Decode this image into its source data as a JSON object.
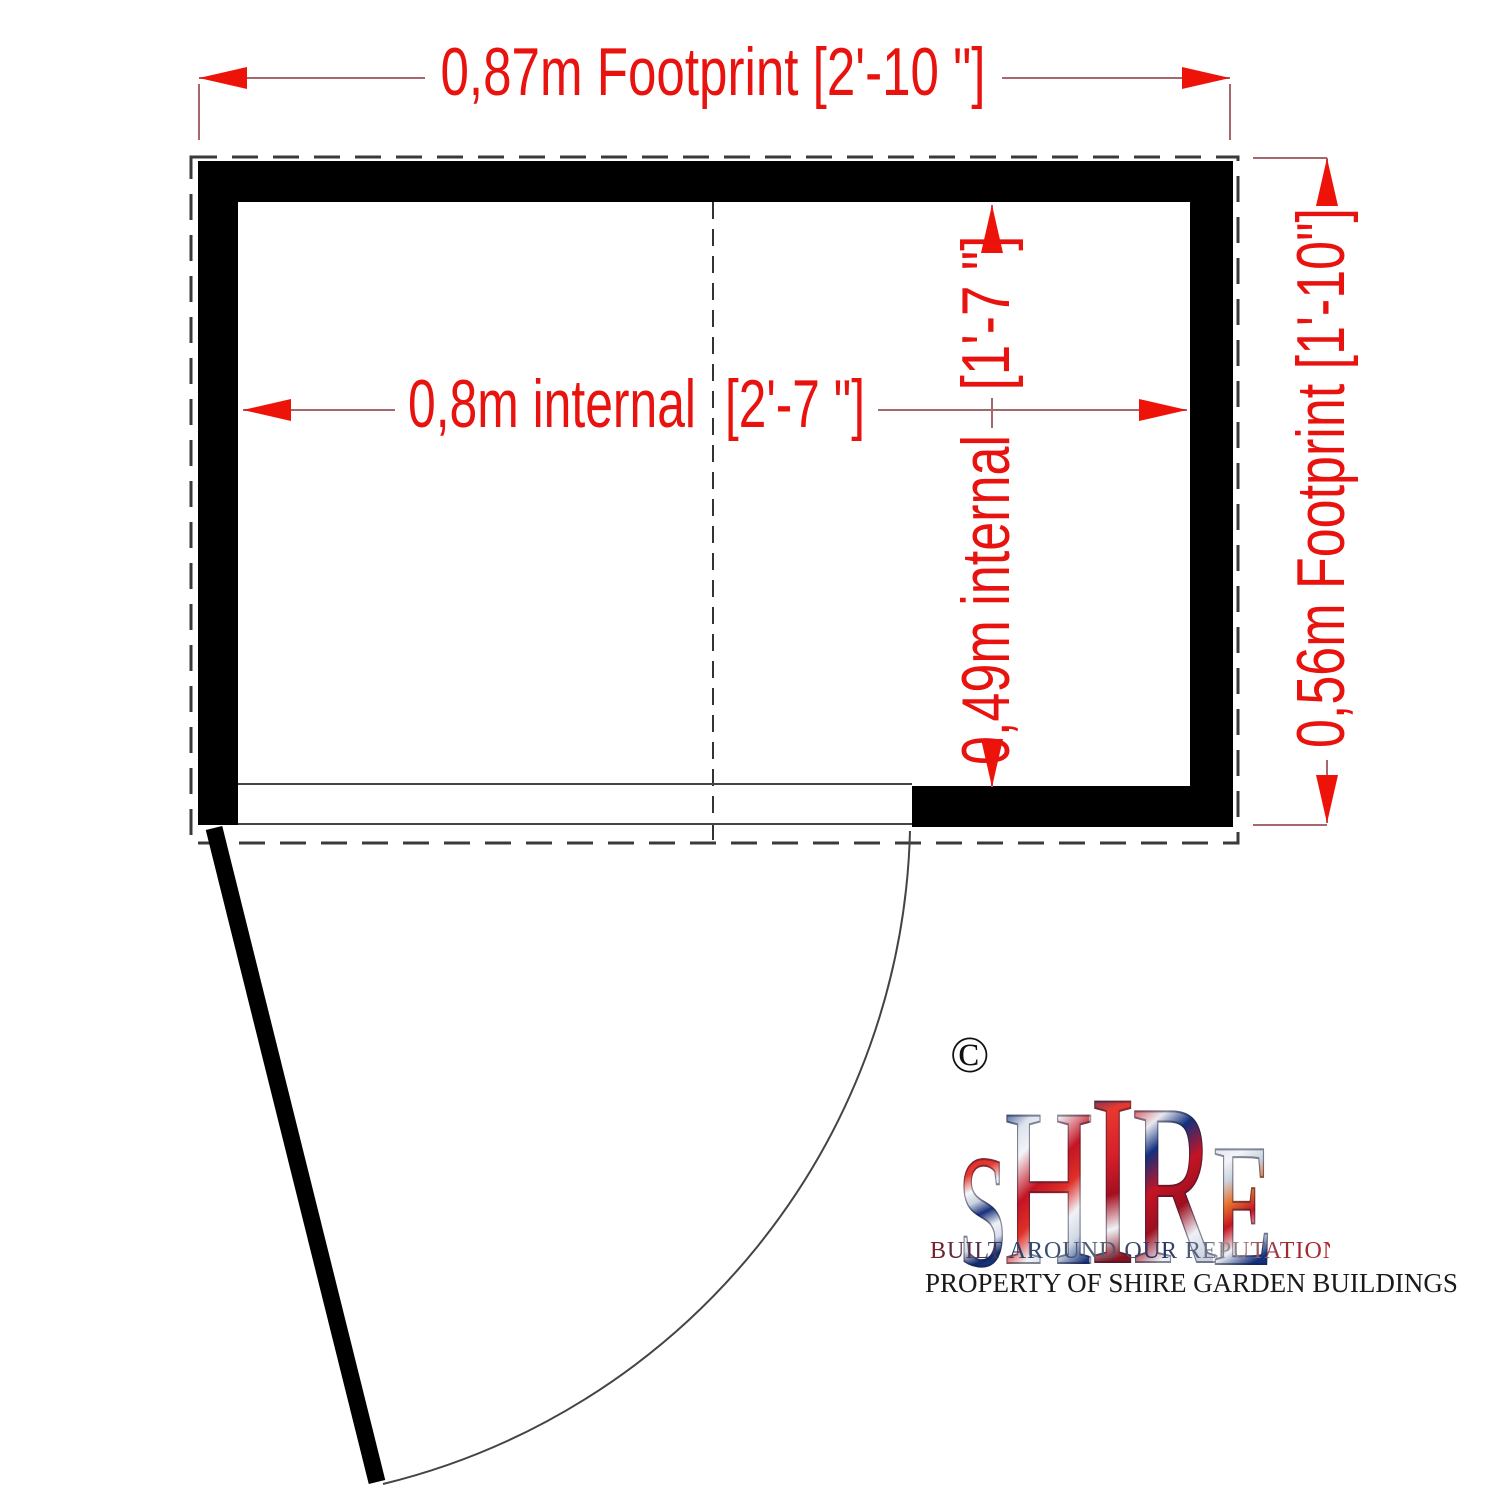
{
  "floorplan": {
    "footprint_width_label": "0,87m Footprint [2'-10 \"]",
    "footprint_depth_label": "0,56m Footprint [1'-10\"]",
    "internal_width_metric": "0,8m internal",
    "internal_width_imperial": "[2'-7 \"]",
    "internal_depth_metric": "0,49m internal",
    "internal_depth_imperial": "[1'-7 \"]"
  },
  "logo": {
    "copyright": "©",
    "letters": [
      "S",
      "H",
      "I",
      "R",
      "E"
    ],
    "tagline": "BUILT AROUND OUR REPUTATION",
    "property_notice": "PROPERTY OF SHIRE GARDEN BUILDINGS"
  },
  "colors": {
    "dimension_text": "#e8120f",
    "dimension_line": "#a5696d",
    "arrow": "#ee1309",
    "wall": "#000000",
    "outline": "#3a3a3a",
    "flag_red": "#c8102e",
    "flag_blue": "#012169"
  }
}
